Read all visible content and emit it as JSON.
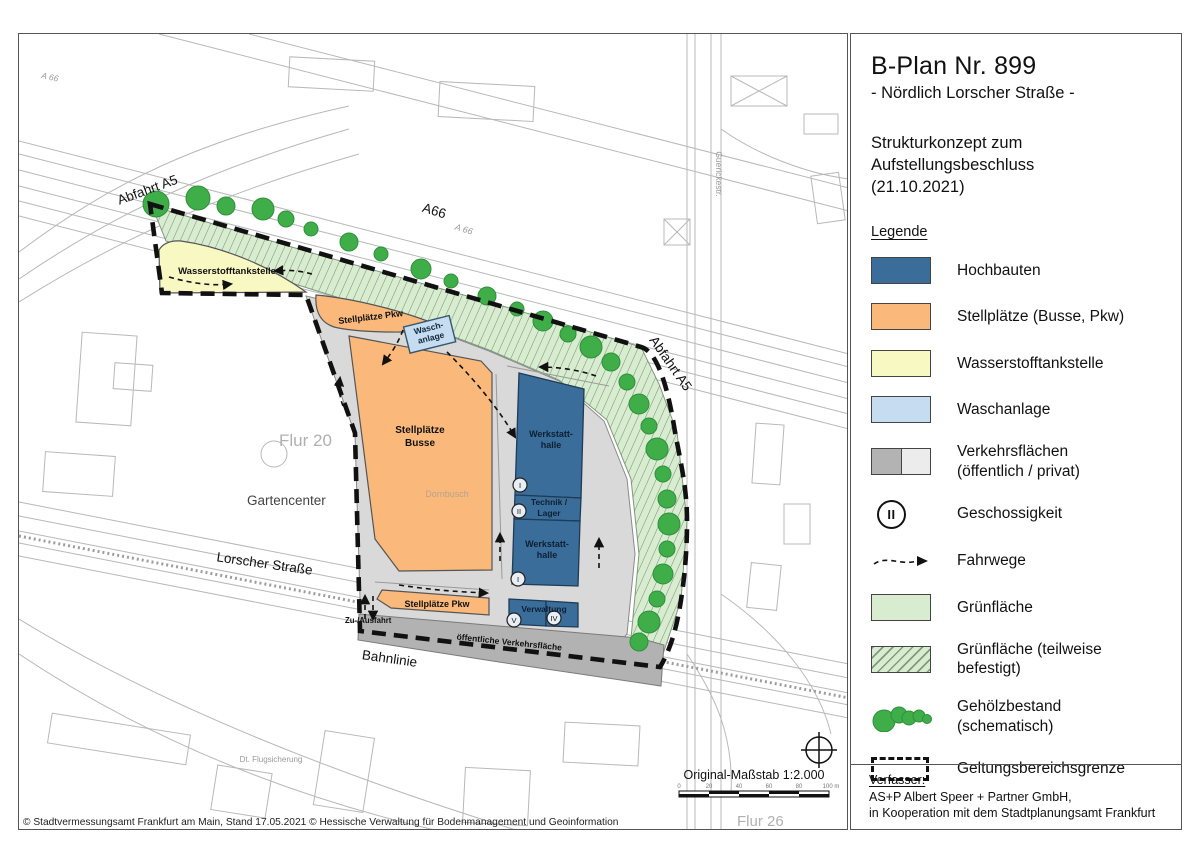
{
  "title_block": {
    "title": "B-Plan Nr. 899",
    "subtitle": "- Nördlich Lorscher Straße -",
    "desc1": "Strukturkonzept zum",
    "desc2": "Aufstellungsbeschluss",
    "desc3": "(21.10.2021)",
    "legend_heading": "Legende"
  },
  "legend": {
    "items": [
      {
        "id": "hochbauten",
        "icon": "building-swatch",
        "type": "solid",
        "color": "#3a6d9a",
        "label": "Hochbauten"
      },
      {
        "id": "stellplaetze",
        "icon": "parking-swatch",
        "type": "solid",
        "color": "#fab97a",
        "label": "Stellplätze (Busse, Pkw)"
      },
      {
        "id": "wasserstofftankstelle",
        "icon": "hydrogen-station-swatch",
        "type": "solid",
        "color": "#f8f8c2",
        "label": "Wasserstofftankstelle"
      },
      {
        "id": "waschanlage",
        "icon": "wash-swatch",
        "type": "solid",
        "color": "#c6dcf1",
        "label": "Waschanlage"
      },
      {
        "id": "verkehrsflaechen",
        "icon": "traffic-area-swatch",
        "type": "split",
        "colors": [
          "#b3b3b3",
          "#ececec"
        ],
        "label": "Verkehrsflächen",
        "label2": "(öffentlich / privat)"
      },
      {
        "id": "geschossigkeit",
        "icon": "storey-circle-icon",
        "type": "circle",
        "symbol": "II",
        "label": "Geschossigkeit"
      },
      {
        "id": "fahrwege",
        "icon": "route-arrow-icon",
        "type": "arrow",
        "label": "Fahrwege"
      },
      {
        "id": "gruenflaeche",
        "icon": "green-area-swatch",
        "type": "solid",
        "color": "#d8edd0",
        "label": "Grünfläche"
      },
      {
        "id": "gruenflaeche-befestigt",
        "icon": "green-hatched-swatch",
        "type": "hatch",
        "color": "#d8edd0",
        "label": "Grünfläche (teilweise befestigt)"
      },
      {
        "id": "gehoelzbestand",
        "icon": "tree-cluster-icon",
        "type": "trees",
        "label": "Gehölzbestand (schematisch)"
      },
      {
        "id": "geltungsbereichsgrenze",
        "icon": "boundary-dashed-icon",
        "type": "dashed",
        "label": "Geltungsbereichsgrenze"
      }
    ]
  },
  "author_block": {
    "heading": "Verfasser:",
    "line1": "AS+P Albert Speer + Partner GmbH,",
    "line2": "in Kooperation mit dem Stadtplanungsamt Frankfurt"
  },
  "map": {
    "labels": {
      "abfahrt_a5_left": "Abfahrt A5",
      "a66": "A66",
      "a66_small": "A 66",
      "a66_topleft": "A 66",
      "abfahrt_a5_right": "Abfahrt A5",
      "wasserstofftankstelle": "Wasserstofftankstelle",
      "stellplaetze_pkw_top": "Stellplätze Pkw",
      "wasch1": "Wasch-",
      "wasch2": "anlage",
      "busse1": "Stellplätze",
      "busse2": "Busse",
      "dornbusch": "Dornbusch",
      "werkstatt1a": "Werkstatt-",
      "werkstatt1b": "halle",
      "technik1": "Technik /",
      "technik2": "Lager",
      "werkstatt2a": "Werkstatt-",
      "werkstatt2b": "halle",
      "verwaltung": "Verwaltung",
      "stellplaetze_pkw_bottom": "Stellplätze Pkw",
      "zu_ausfahrt": "Zu-/Ausfahrt",
      "oeffentliche_verkehrsflaeche": "öffentliche Verkehrsfläche",
      "flur20": "Flur 20",
      "flur26": "Flur 26",
      "gartencenter": "Gartencenter",
      "lorscher_strasse": "Lorscher Straße",
      "bahnlinie": "Bahnlinie",
      "guerickestr": "Guerickestr.",
      "flugsicherung": "Dt. Flugsicherung"
    },
    "storeys": [
      "I",
      "II",
      "I",
      "V",
      "IV"
    ],
    "scale": {
      "text": "Original-Maßstab 1:2.000",
      "ticks": [
        "0",
        "20",
        "40",
        "60",
        "80",
        "100 m"
      ]
    },
    "copyright": "© Stadtvermessungsamt Frankfurt am Main, Stand 17.05.2021 © Hessische Verwaltung für Bodenmanagement und Geoinformation"
  },
  "colors": {
    "hochbauten": "#3a6d9a",
    "stellplaetze": "#fab97a",
    "wasserstoff": "#f8f8c2",
    "waschanlage": "#c6dcf1",
    "verkehr_oeffentlich": "#b3b3b3",
    "verkehr_privat": "#d9d9d9",
    "gruen": "#d8edd0",
    "baum": "#3fae49",
    "grenze": "#111111"
  }
}
